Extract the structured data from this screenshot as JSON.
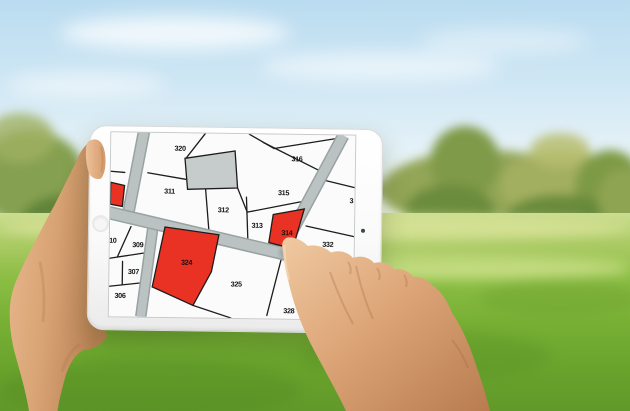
{
  "map": {
    "type": "cadastral-parcel-map",
    "parcels": [
      {
        "label": "320",
        "status": "normal"
      },
      {
        "label": "316",
        "status": "normal"
      },
      {
        "label": "311",
        "status": "normal"
      },
      {
        "label": "315",
        "status": "normal"
      },
      {
        "label": "312",
        "status": "normal"
      },
      {
        "label": "313",
        "status": "normal"
      },
      {
        "label": "314",
        "status": "selected"
      },
      {
        "label": "3",
        "status": "normal-clipped-at-edge"
      },
      {
        "label": "332",
        "status": "normal"
      },
      {
        "label": "10",
        "status": "normal-clipped-at-edge"
      },
      {
        "label": "309",
        "status": "normal"
      },
      {
        "label": "307",
        "status": "normal"
      },
      {
        "label": "306",
        "status": "normal"
      },
      {
        "label": "324",
        "status": "selected"
      },
      {
        "label": "325",
        "status": "normal"
      },
      {
        "label": "328",
        "status": "normal"
      }
    ],
    "colors": {
      "selected_parcel": "#e93223",
      "gray_parcel": "#c5cccb",
      "parcel_fill": "#fbfbfb",
      "boundary": "#1c1c1c",
      "road": "#bac2c2"
    }
  }
}
